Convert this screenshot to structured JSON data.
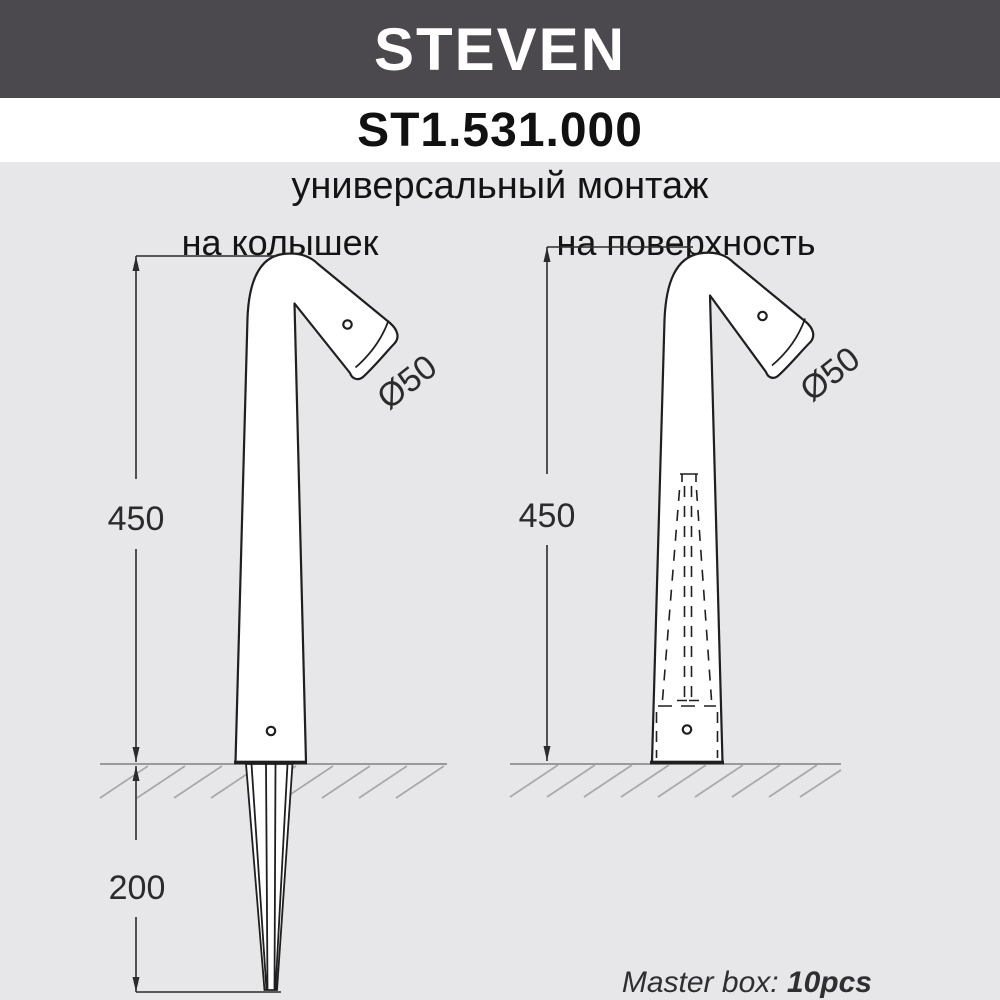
{
  "header": {
    "brand": "STEVEN",
    "model": "ST1.531.000"
  },
  "subtitle": "универсальный монтаж",
  "columns": {
    "left": "на колышек",
    "right": "на поверхность"
  },
  "diagram_left": {
    "height_mm": "450",
    "spike_depth_mm": "200",
    "head_diameter": "Ø50"
  },
  "diagram_right": {
    "height_mm": "450",
    "head_diameter": "Ø50"
  },
  "footer": {
    "label": "Master box: ",
    "value": "10pcs"
  },
  "colors": {
    "banner": "#4b484e",
    "canvas": "#e7e7e9",
    "outline": "#1f1f1f",
    "dimension": "#2b2b2b",
    "hatch": "#a8a8a8",
    "ground": "#9a9a9a"
  }
}
